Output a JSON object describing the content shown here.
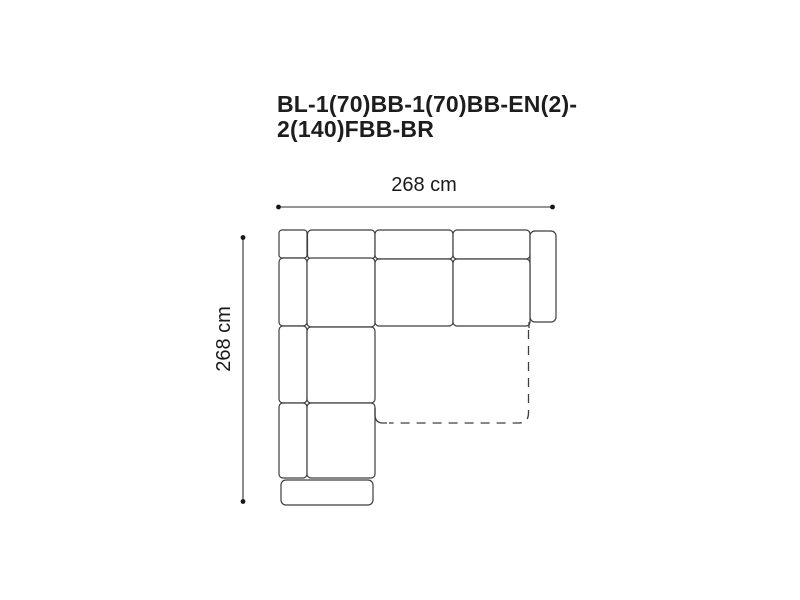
{
  "product": {
    "code_line1": "BL-1(70)BB-1(70)BB-EN(2)-",
    "code_line2": "2(140)FBB-BR",
    "code_full": "BL-1(70)BB-1(70)BB-EN(2)-2(140)FBB-BR"
  },
  "dimensions": {
    "width_label": "268 cm",
    "depth_label": "268 cm"
  },
  "colors": {
    "background": "#ffffff",
    "title_text": "#1d1d1d",
    "dimension_text": "#1a1a1a",
    "outline": "#3d3d3d"
  },
  "diagram": {
    "type": "corner-sofa-top-view",
    "parts": [
      "corner-back-cushion",
      "top-back-cushion-1",
      "top-back-cushion-2",
      "top-back-cushion-3",
      "right-armrest",
      "left-back-cushion-1",
      "left-back-cushion-2",
      "left-back-cushion-3",
      "corner-seat",
      "seat-cushion-2",
      "seat-cushion-3",
      "left-seat-cushion-2",
      "left-seat-cushion-3",
      "front-armrest",
      "fold-out-bed-dashed-outline"
    ]
  }
}
